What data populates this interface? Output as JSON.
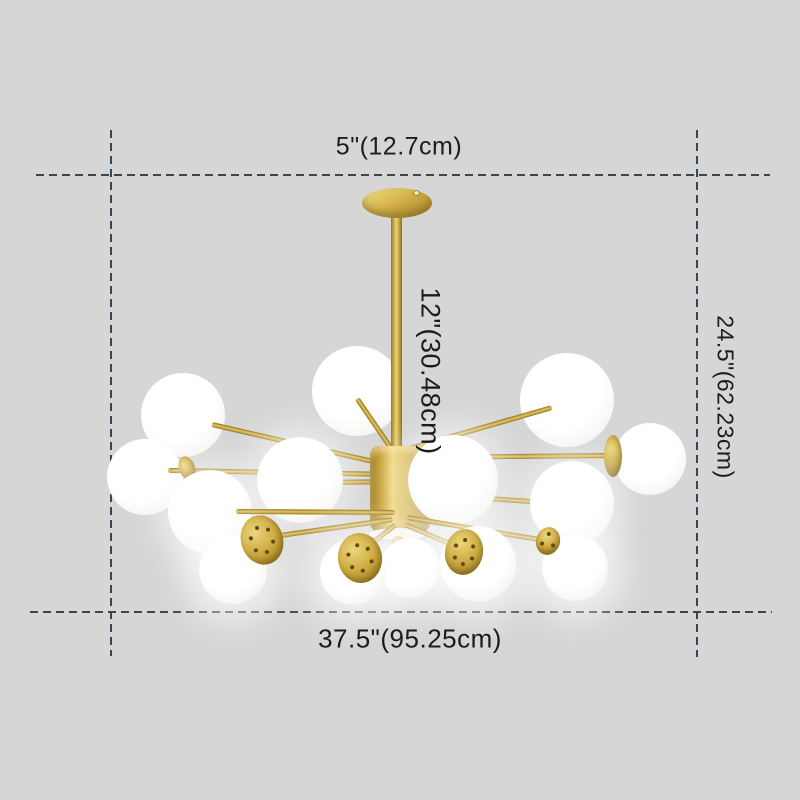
{
  "meta": {
    "description": "Product dimension diagram of a modern brass chandelier with white glass ball shades",
    "canvas": {
      "width": 800,
      "height": 800,
      "background": "#d6d6d6"
    }
  },
  "annotations": {
    "dash_color": "#3a4554",
    "text_color": "#1c1c1c",
    "labels": {
      "canopy_width": "5\"(12.7cm)",
      "rod_length": "12\"(30.48cm)",
      "total_height": "24.5\"(62.23cm)",
      "total_width": "37.5\"(95.25cm)"
    },
    "label_layout": {
      "canopy_width": {
        "x": 399,
        "y": 147,
        "size": 25,
        "rotated": false
      },
      "rod_length": {
        "x": 430,
        "y": 371,
        "size": 27,
        "rotated": true
      },
      "total_height": {
        "x": 725,
        "y": 397,
        "size": 23,
        "rotated": true
      },
      "total_width": {
        "x": 410,
        "y": 639,
        "size": 26,
        "rotated": false
      }
    },
    "lines": {
      "top": {
        "y": 174,
        "x1": 36,
        "x2": 770
      },
      "bottom": {
        "y": 611,
        "x1": 30,
        "x2": 772
      },
      "left": {
        "x": 110,
        "y1": 130,
        "y2": 656
      },
      "right": {
        "x": 696,
        "y1": 130,
        "y2": 657
      }
    }
  },
  "chandelier": {
    "finish": {
      "gold_light": "#eed87f",
      "gold_mid": "#cfae44",
      "gold_dark": "#8f7120",
      "glass": "#ffffff"
    },
    "canopy": {
      "x": 362,
      "y": 188,
      "w": 70,
      "h": 30,
      "screw_x": 414,
      "screw_y": 191
    },
    "rod": {
      "x": 391,
      "y": 214,
      "w": 11,
      "h": 236
    },
    "hub": {
      "x": 370,
      "y": 446,
      "w": 60,
      "h": 88,
      "plate": {
        "x": 369,
        "y": 528,
        "w": 58,
        "h": 12
      },
      "finial": {
        "x": 392,
        "y": 536,
        "d": 12
      },
      "finial_tip": {
        "x": 395,
        "y": 547,
        "d": 7
      }
    },
    "globes": {
      "back": [
        {
          "x": 183,
          "y": 415,
          "r": 42
        },
        {
          "x": 357,
          "y": 391,
          "r": 45
        },
        {
          "x": 567,
          "y": 400,
          "r": 47
        },
        {
          "x": 145,
          "y": 477,
          "r": 38
        },
        {
          "x": 650,
          "y": 459,
          "r": 36
        }
      ],
      "mid": [
        {
          "x": 300,
          "y": 480,
          "r": 43
        },
        {
          "x": 210,
          "y": 512,
          "r": 42
        },
        {
          "x": 453,
          "y": 480,
          "r": 45
        },
        {
          "x": 572,
          "y": 503,
          "r": 42
        }
      ],
      "front": [
        {
          "x": 410,
          "y": 568,
          "r": 30
        },
        {
          "x": 233,
          "y": 570,
          "r": 34
        },
        {
          "x": 353,
          "y": 572,
          "r": 33
        },
        {
          "x": 478,
          "y": 564,
          "r": 38
        },
        {
          "x": 575,
          "y": 568,
          "r": 33
        }
      ]
    },
    "arms": {
      "upper": [
        {
          "x1": 399,
          "y1": 467,
          "x2": 212,
          "y2": 424
        },
        {
          "x1": 396,
          "y1": 455,
          "x2": 357,
          "y2": 398
        },
        {
          "x1": 403,
          "y1": 450,
          "x2": 552,
          "y2": 407
        },
        {
          "x1": 395,
          "y1": 474,
          "x2": 168,
          "y2": 470
        },
        {
          "x1": 405,
          "y1": 457,
          "x2": 616,
          "y2": 455
        },
        {
          "x1": 398,
          "y1": 481,
          "x2": 318,
          "y2": 482
        },
        {
          "x1": 406,
          "y1": 492,
          "x2": 558,
          "y2": 503
        }
      ],
      "lower": [
        {
          "x1": 395,
          "y1": 512,
          "x2": 236,
          "y2": 511
        },
        {
          "x1": 393,
          "y1": 519,
          "x2": 266,
          "y2": 537
        },
        {
          "x1": 396,
          "y1": 524,
          "x2": 361,
          "y2": 551
        },
        {
          "x1": 405,
          "y1": 524,
          "x2": 461,
          "y2": 548
        },
        {
          "x1": 407,
          "y1": 517,
          "x2": 551,
          "y2": 541
        }
      ]
    },
    "caps": [
      {
        "x": 613,
        "y": 456,
        "rx": 9,
        "ry": 21,
        "rot": 0,
        "holes": 0
      },
      {
        "x": 187,
        "y": 468,
        "rx": 8,
        "ry": 12,
        "rot": -20,
        "holes": 0
      }
    ],
    "sockets": [
      {
        "x": 262,
        "y": 540,
        "rx": 21,
        "ry": 25,
        "rot": -18,
        "holes": 6
      },
      {
        "x": 360,
        "y": 558,
        "rx": 22,
        "ry": 25,
        "rot": -8,
        "holes": 6
      },
      {
        "x": 464,
        "y": 552,
        "rx": 19,
        "ry": 23,
        "rot": 10,
        "holes": 6
      },
      {
        "x": 548,
        "y": 541,
        "rx": 12,
        "ry": 14,
        "rot": 15,
        "holes": 3
      }
    ]
  }
}
